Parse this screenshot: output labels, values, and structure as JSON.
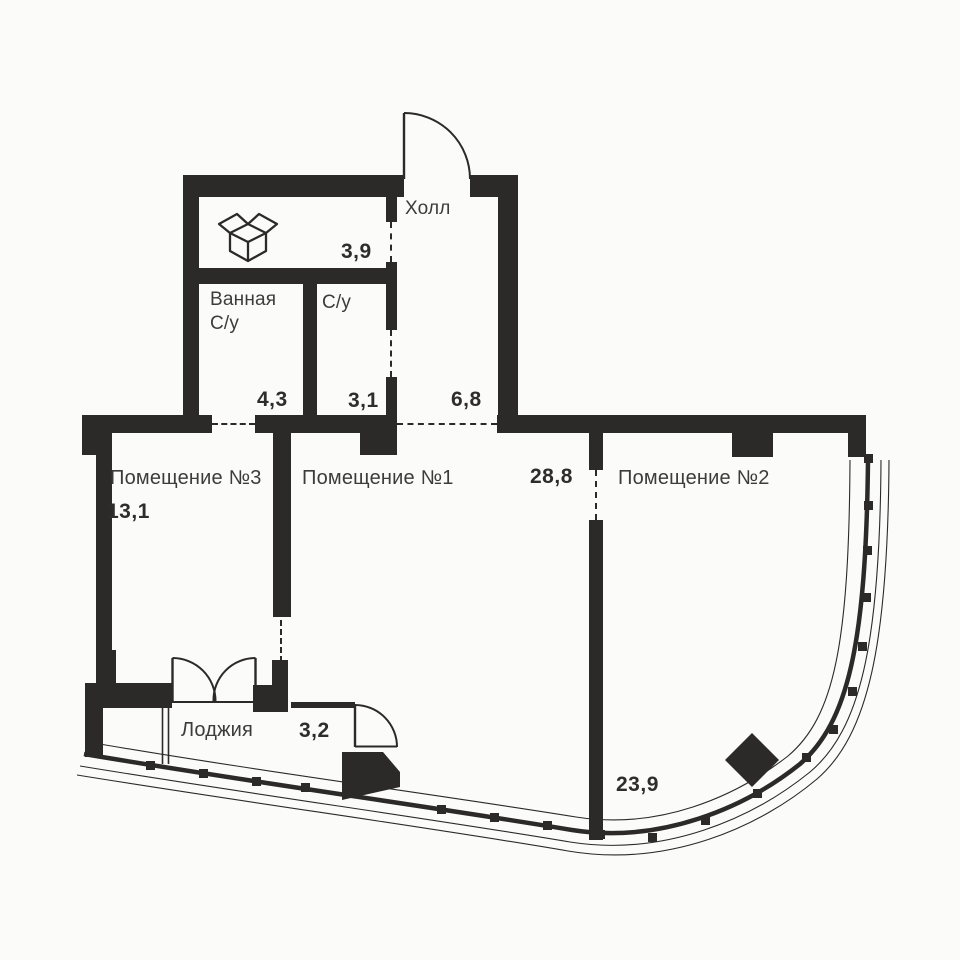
{
  "plan": {
    "type": "apartment-floor-plan",
    "language": "ru",
    "colors": {
      "wall": "#2b2a29",
      "text": "#3c3c3c",
      "background": "#fbfbfa"
    },
    "rooms": [
      {
        "id": "storage",
        "name": "",
        "icon": "open-box-icon",
        "area": "3,9"
      },
      {
        "id": "hall",
        "name": "Холл",
        "area": "6,8"
      },
      {
        "id": "bathroom",
        "name_line1": "Ванная",
        "name_line2": "С/у",
        "area": "4,3"
      },
      {
        "id": "wc",
        "name": "С/у",
        "area": "3,1"
      },
      {
        "id": "room3",
        "name": "Помещение №3",
        "area": "13,1"
      },
      {
        "id": "room1",
        "name": "Помещение №1",
        "area": "28,8"
      },
      {
        "id": "room2",
        "name": "Помещение №2",
        "area": "23,9"
      },
      {
        "id": "loggia",
        "name": "Лоджия",
        "area": "3,2"
      }
    ]
  }
}
